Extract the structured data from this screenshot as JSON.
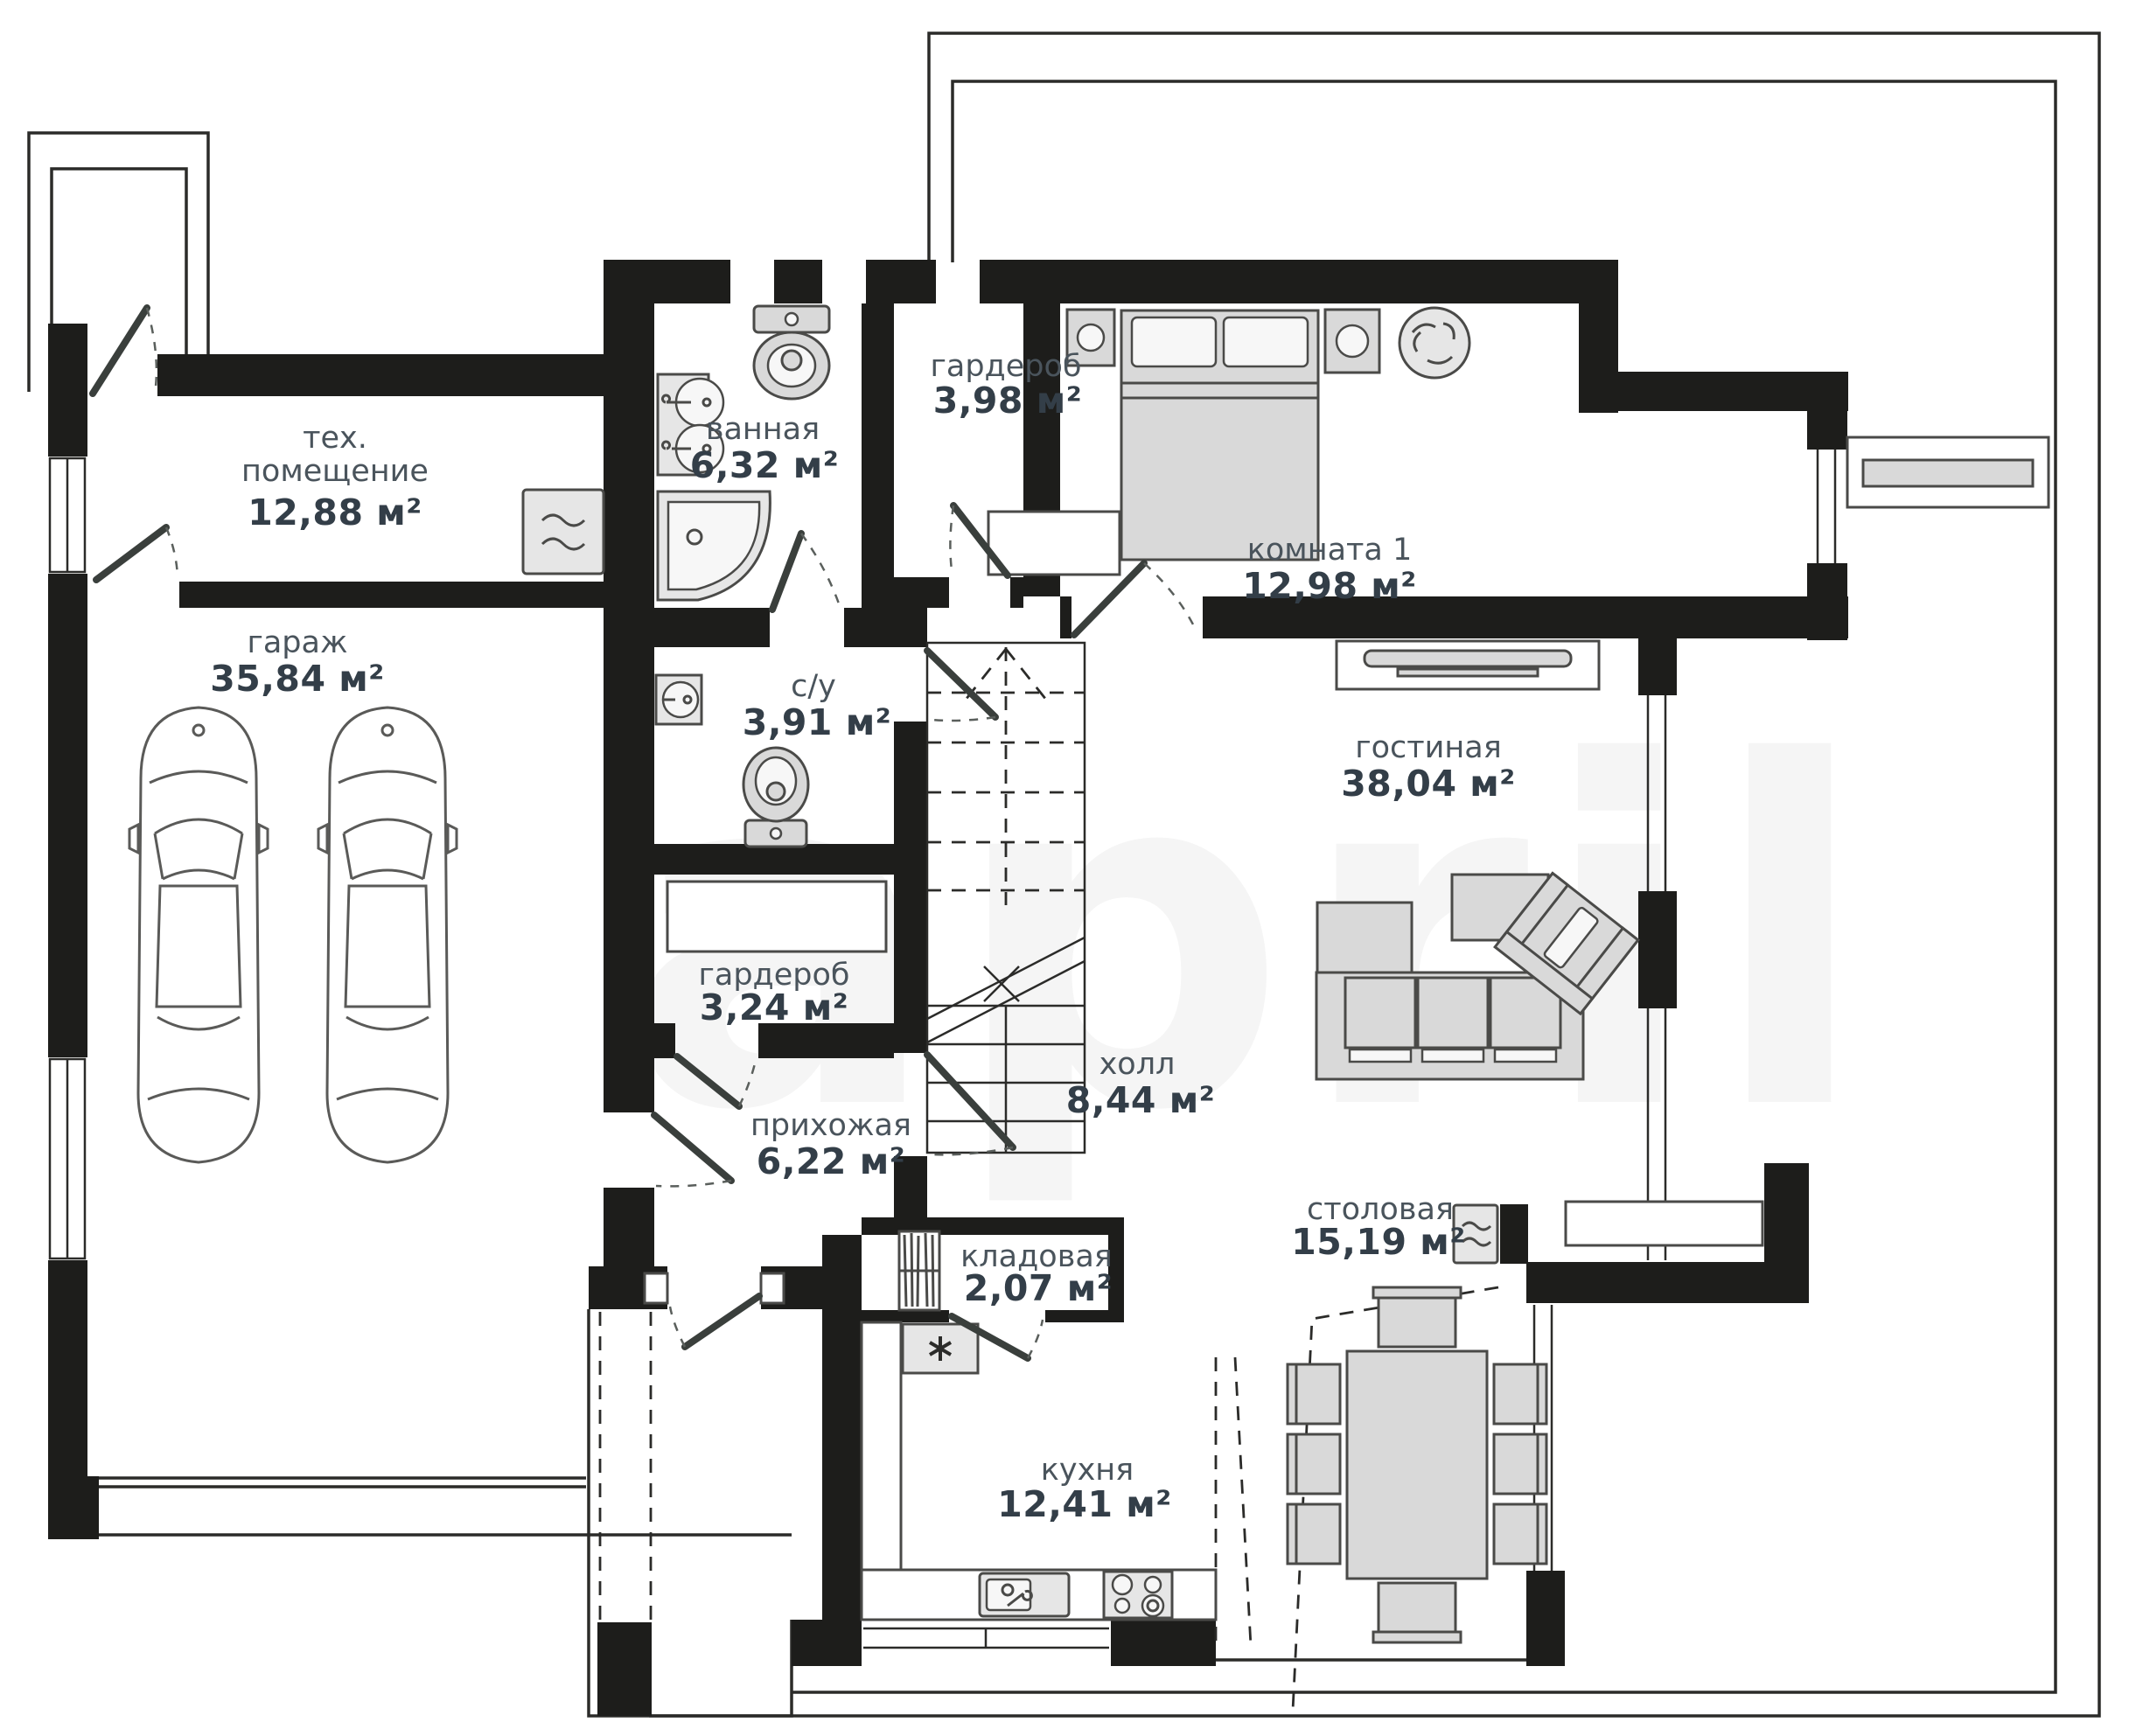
{
  "plan": {
    "watermark": "april",
    "rooms": [
      {
        "id": "tech-room",
        "label1": "тех.",
        "label2": "помещение",
        "area": "12,88 м²"
      },
      {
        "id": "bathroom",
        "label": "ванная",
        "area": "6,32 м²"
      },
      {
        "id": "wardrobe-top",
        "label": "гардероб",
        "area": "3,98 м²"
      },
      {
        "id": "bedroom",
        "label": "комната 1",
        "area": "12,98 м²"
      },
      {
        "id": "garage",
        "label": "гараж",
        "area": "35,84 м²"
      },
      {
        "id": "wc",
        "label": "с/у",
        "area": "3,91 м²"
      },
      {
        "id": "wardrobe-mid",
        "label": "гардероб",
        "area": "3,24 м²"
      },
      {
        "id": "living-room",
        "label": "гостиная",
        "area": "38,04 м²"
      },
      {
        "id": "hall",
        "label": "холл",
        "area": "8,44 м²"
      },
      {
        "id": "entry",
        "label": "прихожая",
        "area": "6,22 м²"
      },
      {
        "id": "pantry",
        "label": "кладовая",
        "area": "2,07 м²"
      },
      {
        "id": "kitchen",
        "label": "кухня",
        "area": "12,41 м²"
      },
      {
        "id": "dining",
        "label": "столовая",
        "area": "15,19 м²"
      }
    ]
  }
}
